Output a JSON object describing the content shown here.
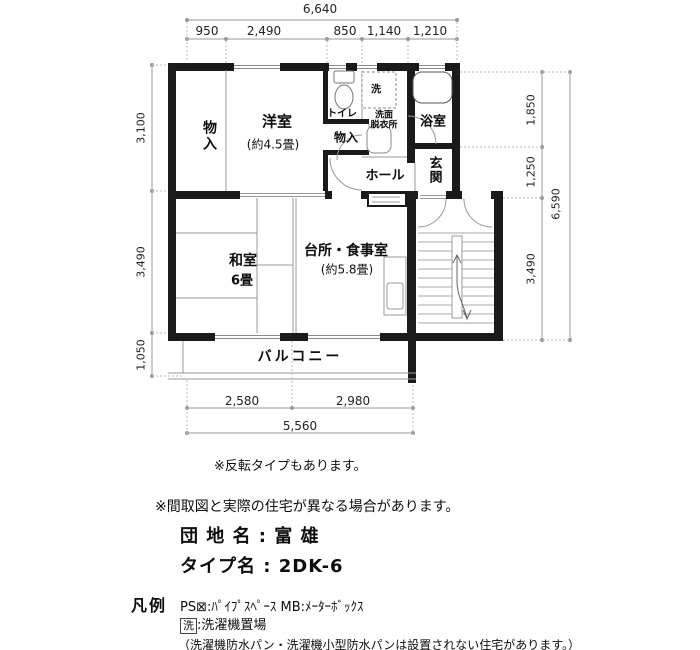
{
  "plan": {
    "dims": {
      "top_total": "6,640",
      "top_segments": [
        "950",
        "2,490",
        "850",
        "1,140",
        "1,210"
      ],
      "left_segments": [
        "3,100",
        "3,490",
        "1,050"
      ],
      "right_segments": [
        "1,850",
        "1,250",
        "3,490"
      ],
      "right_total": "6,590",
      "bottom_segments": [
        "2,580",
        "2,980"
      ],
      "bottom_total": "5,560"
    },
    "rooms": {
      "closet_left": "物入",
      "western_room": "洋室",
      "western_room_size": "(約4.5畳)",
      "toilet": "トイレ",
      "closet_mid": "物入",
      "laundry": "洗",
      "washroom_line1": "洗面",
      "washroom_line2": "脱衣所",
      "bathroom": "浴室",
      "entrance": "玄関",
      "hall": "ホール",
      "japanese_room": "和室",
      "japanese_room_size": "6畳",
      "kitchen": "台所・食事室",
      "kitchen_size": "(約5.8畳)",
      "balcony": "バルコニー"
    }
  },
  "notes": {
    "note1": "※反転タイプもあります。",
    "note2": "※間取図と実際の住宅が異なる場合があります。",
    "estate_row": "団 地 名 : 富 雄",
    "type_row": "タイプ名 : 2DK-6",
    "legend_title": "凡例",
    "legend_ps": "PS⊠:ﾊﾟｲﾌﾟｽﾍﾟｰｽ MB:ﾒｰﾀｰﾎﾞｯｸｽ",
    "legend_wash_symbol": "洗",
    "legend_wash_text": ":洗濯機置場",
    "legend_note": "（洗濯機防水パン・洗濯機小型防水パンは設置されない住宅があります。）"
  }
}
